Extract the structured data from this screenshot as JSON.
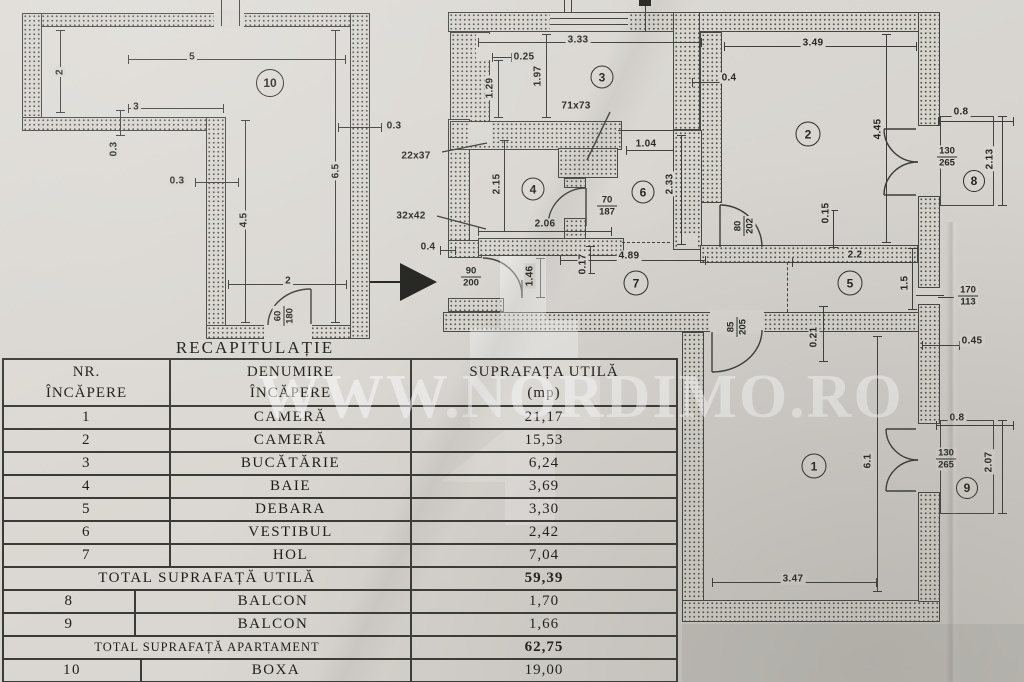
{
  "watermark": {
    "text": "WWW.NORDIMO.RO"
  },
  "table": {
    "title": "RECAPITULAȚIE",
    "header": {
      "col1": [
        "NR.",
        "ÎNCĂPERE"
      ],
      "col2": [
        "DENUMIRE",
        "ÎNCĂPERE"
      ],
      "col3": [
        "SUPRAFAȚA UTILĂ",
        "(mp)"
      ]
    },
    "rows": [
      {
        "kind": "room",
        "nr": "1",
        "name": "CAMERĂ",
        "area": "21,17"
      },
      {
        "kind": "room",
        "nr": "2",
        "name": "CAMERĂ",
        "area": "15,53"
      },
      {
        "kind": "room",
        "nr": "3",
        "name": "BUCĂTĂRIE",
        "area": "6,24"
      },
      {
        "kind": "room",
        "nr": "4",
        "name": "BAIE",
        "area": "3,69"
      },
      {
        "kind": "room",
        "nr": "5",
        "name": "DEBARA",
        "area": "3,30"
      },
      {
        "kind": "room",
        "nr": "6",
        "name": "VESTIBUL",
        "area": "2,42"
      },
      {
        "kind": "room",
        "nr": "7",
        "name": "HOL",
        "area": "7,04"
      },
      {
        "kind": "total",
        "label": "TOTAL  SUPRAFAȚĂ  UTILĂ",
        "area": "59,39"
      },
      {
        "kind": "room",
        "nr": "8",
        "name": "BALCON",
        "area": "1,70"
      },
      {
        "kind": "room",
        "nr": "9",
        "name": "BALCON",
        "area": "1,66"
      },
      {
        "kind": "total_small",
        "label": "TOTAL SUPRAFAȚĂ APARTAMENT",
        "area": "62,75"
      },
      {
        "kind": "room",
        "nr": "10",
        "name": "BOXA",
        "area": "19,00"
      },
      {
        "kind": "total",
        "label": "TOTAL  SUPRAFAȚĂ",
        "area": "81,75"
      }
    ]
  },
  "plan": {
    "room_numbers": [
      {
        "n": "10",
        "x": 270,
        "y": 83,
        "d": 28
      },
      {
        "n": "3",
        "x": 602,
        "y": 77,
        "d": 23
      },
      {
        "n": "4",
        "x": 533,
        "y": 189,
        "d": 23
      },
      {
        "n": "6",
        "x": 643,
        "y": 192,
        "d": 23
      },
      {
        "n": "2",
        "x": 808,
        "y": 134,
        "d": 25
      },
      {
        "n": "7",
        "x": 636,
        "y": 283,
        "d": 25
      },
      {
        "n": "5",
        "x": 850,
        "y": 283,
        "d": 25
      },
      {
        "n": "1",
        "x": 814,
        "y": 466,
        "d": 25
      },
      {
        "n": "8",
        "x": 974,
        "y": 181,
        "d": 22
      },
      {
        "n": "9",
        "x": 967,
        "y": 488,
        "d": 22
      }
    ],
    "dimension_labels": [
      {
        "t": "5",
        "x": 192,
        "y": 57
      },
      {
        "t": "2",
        "x": 60,
        "y": 72,
        "r": 1
      },
      {
        "t": "3",
        "x": 136,
        "y": 107
      },
      {
        "t": "0.3",
        "x": 114,
        "y": 149,
        "r": 1
      },
      {
        "t": "0.3",
        "x": 177,
        "y": 181
      },
      {
        "t": "0.3",
        "x": 394,
        "y": 126
      },
      {
        "t": "6.5",
        "x": 336,
        "y": 171,
        "r": 1
      },
      {
        "t": "4.5",
        "x": 244,
        "y": 220,
        "r": 1
      },
      {
        "t": "2",
        "x": 288,
        "y": 281
      },
      {
        "t": "3.33",
        "x": 578,
        "y": 40
      },
      {
        "t": "0.25",
        "x": 524,
        "y": 57
      },
      {
        "t": "1.29",
        "x": 490,
        "y": 88,
        "r": 1
      },
      {
        "t": "1.97",
        "x": 538,
        "y": 76,
        "r": 1
      },
      {
        "t": "71x73",
        "x": 576,
        "y": 106
      },
      {
        "t": "22x37",
        "x": 416,
        "y": 156
      },
      {
        "t": "32x42",
        "x": 411,
        "y": 216
      },
      {
        "t": "0.4",
        "x": 428,
        "y": 247
      },
      {
        "t": "2.15",
        "x": 497,
        "y": 184,
        "r": 1
      },
      {
        "t": "2.06",
        "x": 545,
        "y": 224
      },
      {
        "t": "1.04",
        "x": 646,
        "y": 144
      },
      {
        "t": "2.33",
        "x": 670,
        "y": 184,
        "r": 1
      },
      {
        "t": "0.4",
        "x": 729,
        "y": 78
      },
      {
        "t": "3.49",
        "x": 813,
        "y": 43
      },
      {
        "t": "4.45",
        "x": 878,
        "y": 129,
        "r": 1
      },
      {
        "t": "0.15",
        "x": 826,
        "y": 213,
        "r": 1
      },
      {
        "t": "4.89",
        "x": 629,
        "y": 256
      },
      {
        "t": "0.17",
        "x": 583,
        "y": 264,
        "r": 1
      },
      {
        "t": "2.2",
        "x": 855,
        "y": 255
      },
      {
        "t": "1.5",
        "x": 905,
        "y": 283,
        "r": 1
      },
      {
        "t": "0.45",
        "x": 972,
        "y": 341
      },
      {
        "t": "0.21",
        "x": 814,
        "y": 337,
        "r": 1
      },
      {
        "t": "6.1",
        "x": 868,
        "y": 461,
        "r": 1
      },
      {
        "t": "3.47",
        "x": 793,
        "y": 579
      },
      {
        "t": "0.8",
        "x": 961,
        "y": 112
      },
      {
        "t": "2.13",
        "x": 990,
        "y": 159,
        "r": 1
      },
      {
        "t": "0.8",
        "x": 957,
        "y": 418
      },
      {
        "t": "2.07",
        "x": 989,
        "y": 462,
        "r": 1
      },
      {
        "t": "1.46",
        "x": 530,
        "y": 276,
        "r": 1
      }
    ],
    "door_window_labels": [
      {
        "top": "60",
        "bottom": "180",
        "x": 284,
        "y": 316,
        "r": 1
      },
      {
        "top": "90",
        "bottom": "200",
        "x": 471,
        "y": 277
      },
      {
        "top": "70",
        "bottom": "187",
        "x": 607,
        "y": 206
      },
      {
        "top": "80",
        "bottom": "202",
        "x": 744,
        "y": 226,
        "r": 1
      },
      {
        "top": "85",
        "bottom": "205",
        "x": 737,
        "y": 327,
        "r": 1
      },
      {
        "top": "130",
        "bottom": "265",
        "x": 947,
        "y": 157
      },
      {
        "top": "170",
        "bottom": "113",
        "x": 968,
        "y": 296
      },
      {
        "top": "130",
        "bottom": "265",
        "x": 946,
        "y": 459
      }
    ]
  }
}
